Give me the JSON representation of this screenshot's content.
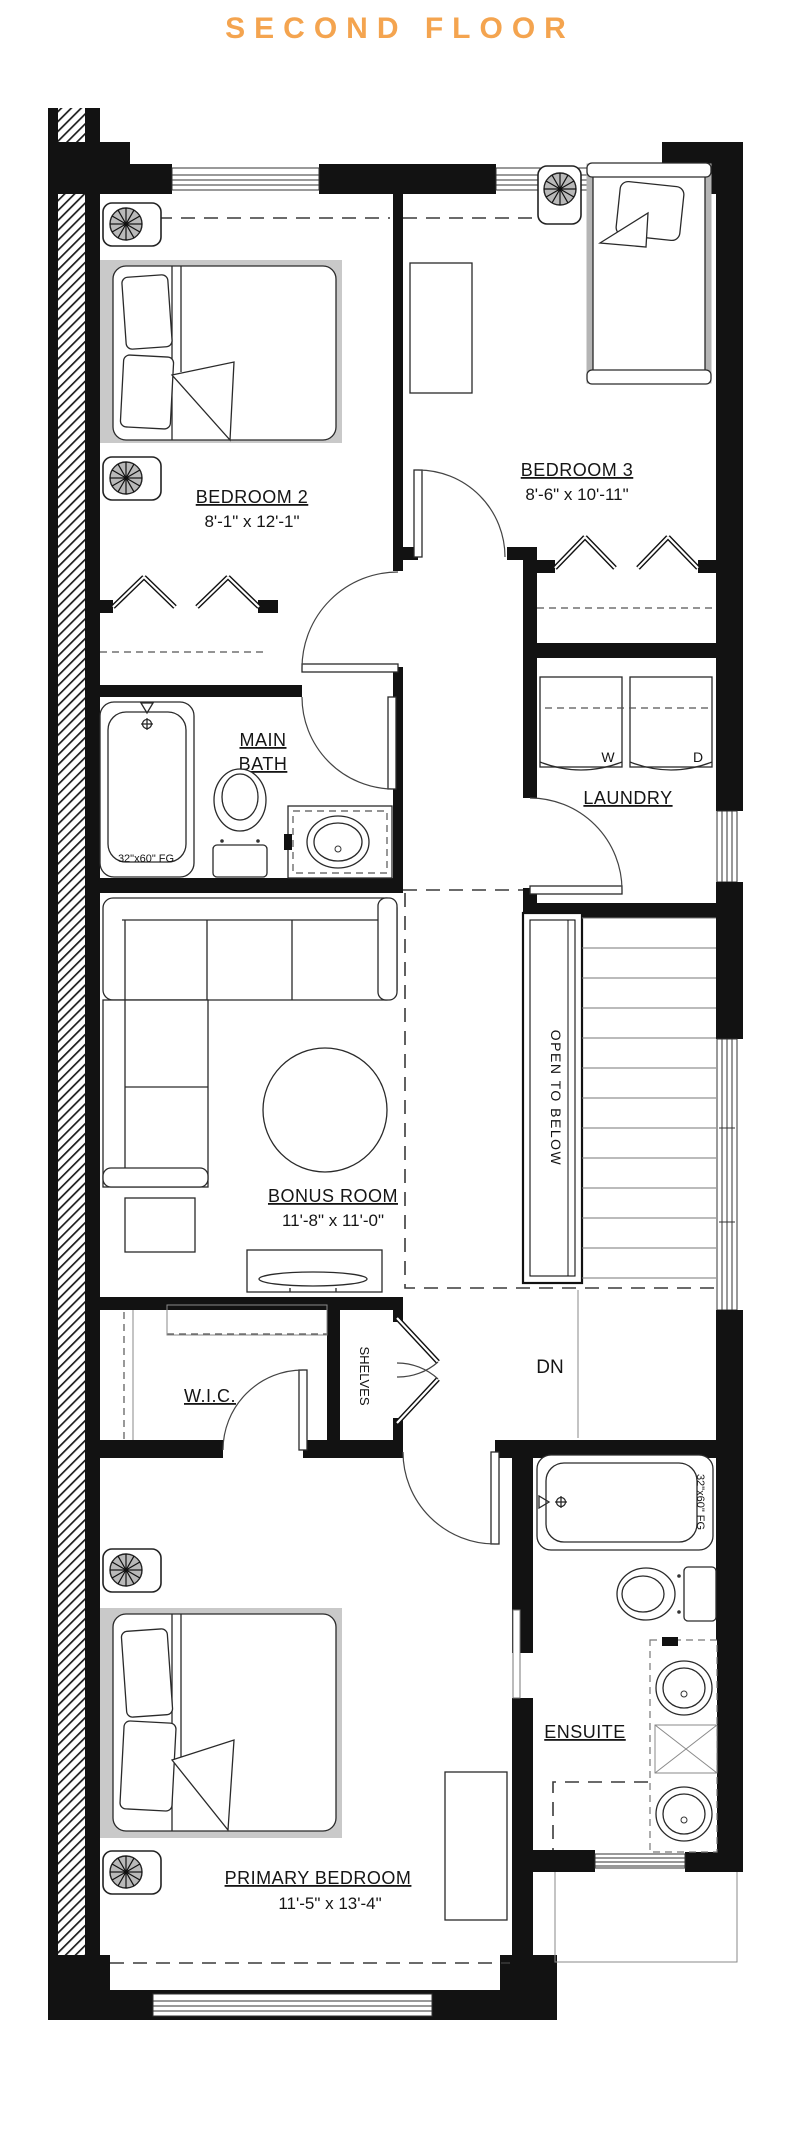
{
  "title": "SECOND FLOOR",
  "accent_color": "#F4A44F",
  "wall_color": "#121212",
  "rug_color": "#C9C9C9",
  "rooms": {
    "bedroom2": {
      "label": "BEDROOM 2",
      "dims": "8'-1\" x 12'-1\""
    },
    "bedroom3": {
      "label": "BEDROOM 3",
      "dims": "8'-6\" x 10'-11\""
    },
    "main_bath": {
      "label_line1": "MAIN",
      "label_line2": "BATH",
      "tub_label": "32\"x60\" FG"
    },
    "laundry": {
      "label": "LAUNDRY",
      "washer_label": "W",
      "dryer_label": "D"
    },
    "bonus_room": {
      "label": "BONUS ROOM",
      "dims": "11'-8\" x 11'-0\""
    },
    "stairwell": {
      "open_to_below_label": "OPEN TO BELOW",
      "down_label": "DN"
    },
    "wic": {
      "label": "W.I.C."
    },
    "shelves_closet": {
      "label": "SHELVES"
    },
    "ensuite": {
      "label": "ENSUITE",
      "tub_label": "32\"x60\" FG"
    },
    "primary_bedroom": {
      "label": "PRIMARY BEDROOM",
      "dims": "11'-5\" x 13'-4\""
    }
  }
}
